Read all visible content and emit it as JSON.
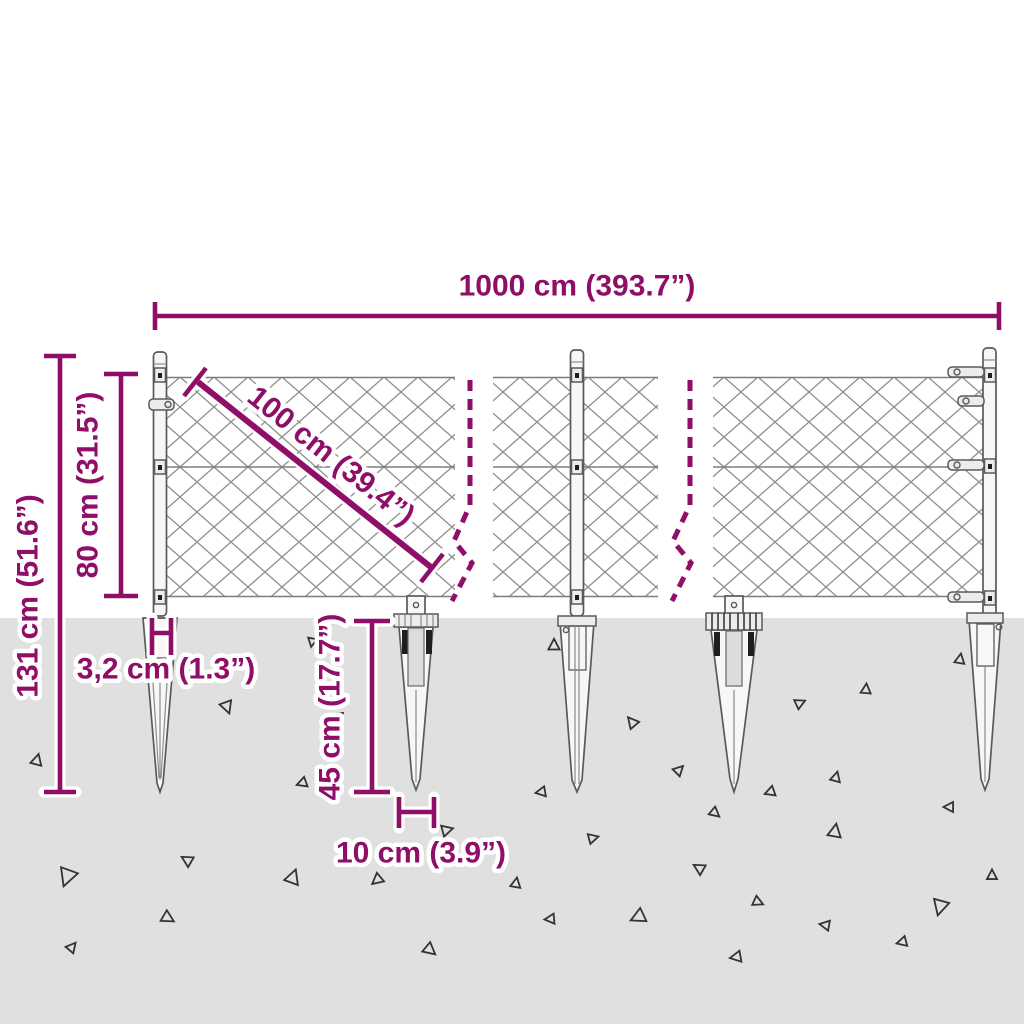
{
  "colors": {
    "accent": "#8e0e68",
    "ground": "#e0e0e0",
    "mesh": "#8f8f8f",
    "steel_outline": "#5a5a5a",
    "halo": "#ffffff"
  },
  "labels": {
    "total_width": "1000 cm (393.7”)",
    "panel_width": "100 cm (39.4”)",
    "mesh_height": "80 cm (31.5”)",
    "total_height": "131 cm (51.6”)",
    "spike_diameter": "3,2 cm (1.3”)",
    "spike_length": "45 cm (17.7”)",
    "spike_spacing": "10 cm (3.9”)"
  },
  "ground": {
    "triangles": [
      {
        "x": 37,
        "y": 760,
        "s": 10,
        "r": 15
      },
      {
        "x": 67,
        "y": 877,
        "s": 16,
        "r": 200
      },
      {
        "x": 227,
        "y": 707,
        "s": 11,
        "r": 160
      },
      {
        "x": 187,
        "y": 860,
        "s": 10,
        "r": 300
      },
      {
        "x": 168,
        "y": 918,
        "s": 11,
        "r": 120
      },
      {
        "x": 72,
        "y": 947,
        "s": 9,
        "r": 40
      },
      {
        "x": 302,
        "y": 783,
        "s": 9,
        "r": 250
      },
      {
        "x": 293,
        "y": 877,
        "s": 13,
        "r": 20
      },
      {
        "x": 377,
        "y": 880,
        "s": 10,
        "r": 230
      },
      {
        "x": 430,
        "y": 950,
        "s": 11,
        "r": 130
      },
      {
        "x": 447,
        "y": 830,
        "s": 10,
        "r": 75
      },
      {
        "x": 312,
        "y": 642,
        "s": 8,
        "r": 190
      },
      {
        "x": 338,
        "y": 716,
        "s": 8,
        "r": 290
      },
      {
        "x": 554,
        "y": 645,
        "s": 10,
        "r": 0
      },
      {
        "x": 632,
        "y": 722,
        "s": 10,
        "r": 320
      },
      {
        "x": 679,
        "y": 770,
        "s": 9,
        "r": 45
      },
      {
        "x": 541,
        "y": 792,
        "s": 9,
        "r": 260
      },
      {
        "x": 715,
        "y": 813,
        "s": 9,
        "r": 130
      },
      {
        "x": 770,
        "y": 792,
        "s": 9,
        "r": 250
      },
      {
        "x": 593,
        "y": 838,
        "s": 9,
        "r": 75
      },
      {
        "x": 699,
        "y": 868,
        "s": 10,
        "r": 300
      },
      {
        "x": 516,
        "y": 883,
        "s": 9,
        "r": 10
      },
      {
        "x": 550,
        "y": 919,
        "s": 9,
        "r": 265
      },
      {
        "x": 638,
        "y": 917,
        "s": 13,
        "r": 245
      },
      {
        "x": 736,
        "y": 957,
        "s": 10,
        "r": 260
      },
      {
        "x": 758,
        "y": 902,
        "s": 9,
        "r": 115
      },
      {
        "x": 825,
        "y": 925,
        "s": 9,
        "r": 280
      },
      {
        "x": 800,
        "y": 703,
        "s": 9,
        "r": 65
      },
      {
        "x": 866,
        "y": 689,
        "s": 9,
        "r": 5
      },
      {
        "x": 836,
        "y": 777,
        "s": 9,
        "r": 15
      },
      {
        "x": 835,
        "y": 831,
        "s": 12,
        "r": 10
      },
      {
        "x": 949,
        "y": 807,
        "s": 9,
        "r": 270
      },
      {
        "x": 960,
        "y": 659,
        "s": 9,
        "r": 10
      },
      {
        "x": 940,
        "y": 907,
        "s": 14,
        "r": 195
      },
      {
        "x": 992,
        "y": 875,
        "s": 9,
        "r": 0
      },
      {
        "x": 902,
        "y": 942,
        "s": 9,
        "r": 255
      }
    ]
  }
}
